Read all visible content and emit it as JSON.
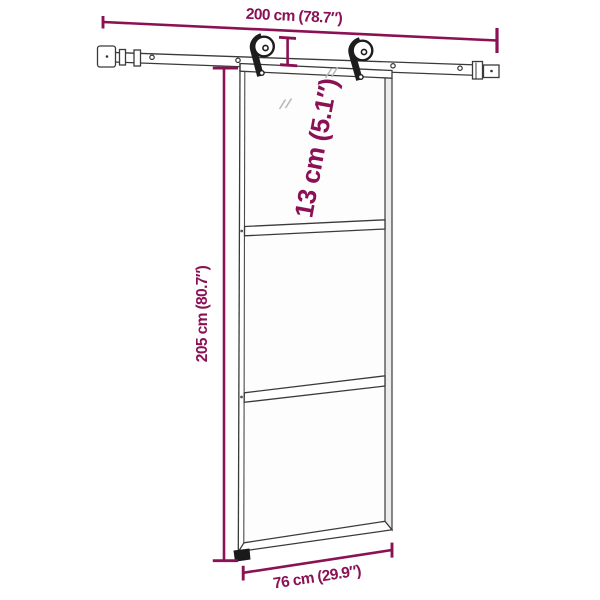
{
  "diagram": {
    "type": "product-dimension-diagram",
    "subject": "sliding-glass-door-with-rail-hardware",
    "labels": {
      "rail_width": "200 cm (78.7″)",
      "hardware_height": "13 cm (5.1″)",
      "door_height": "205 cm (80.7″)",
      "door_width": "76 cm (29.9″)"
    },
    "colors": {
      "dimension_accent": "#8B1155",
      "line_dark": "#3a3a3a",
      "hardware_black": "#1d1d1d",
      "background": "#ffffff"
    }
  }
}
